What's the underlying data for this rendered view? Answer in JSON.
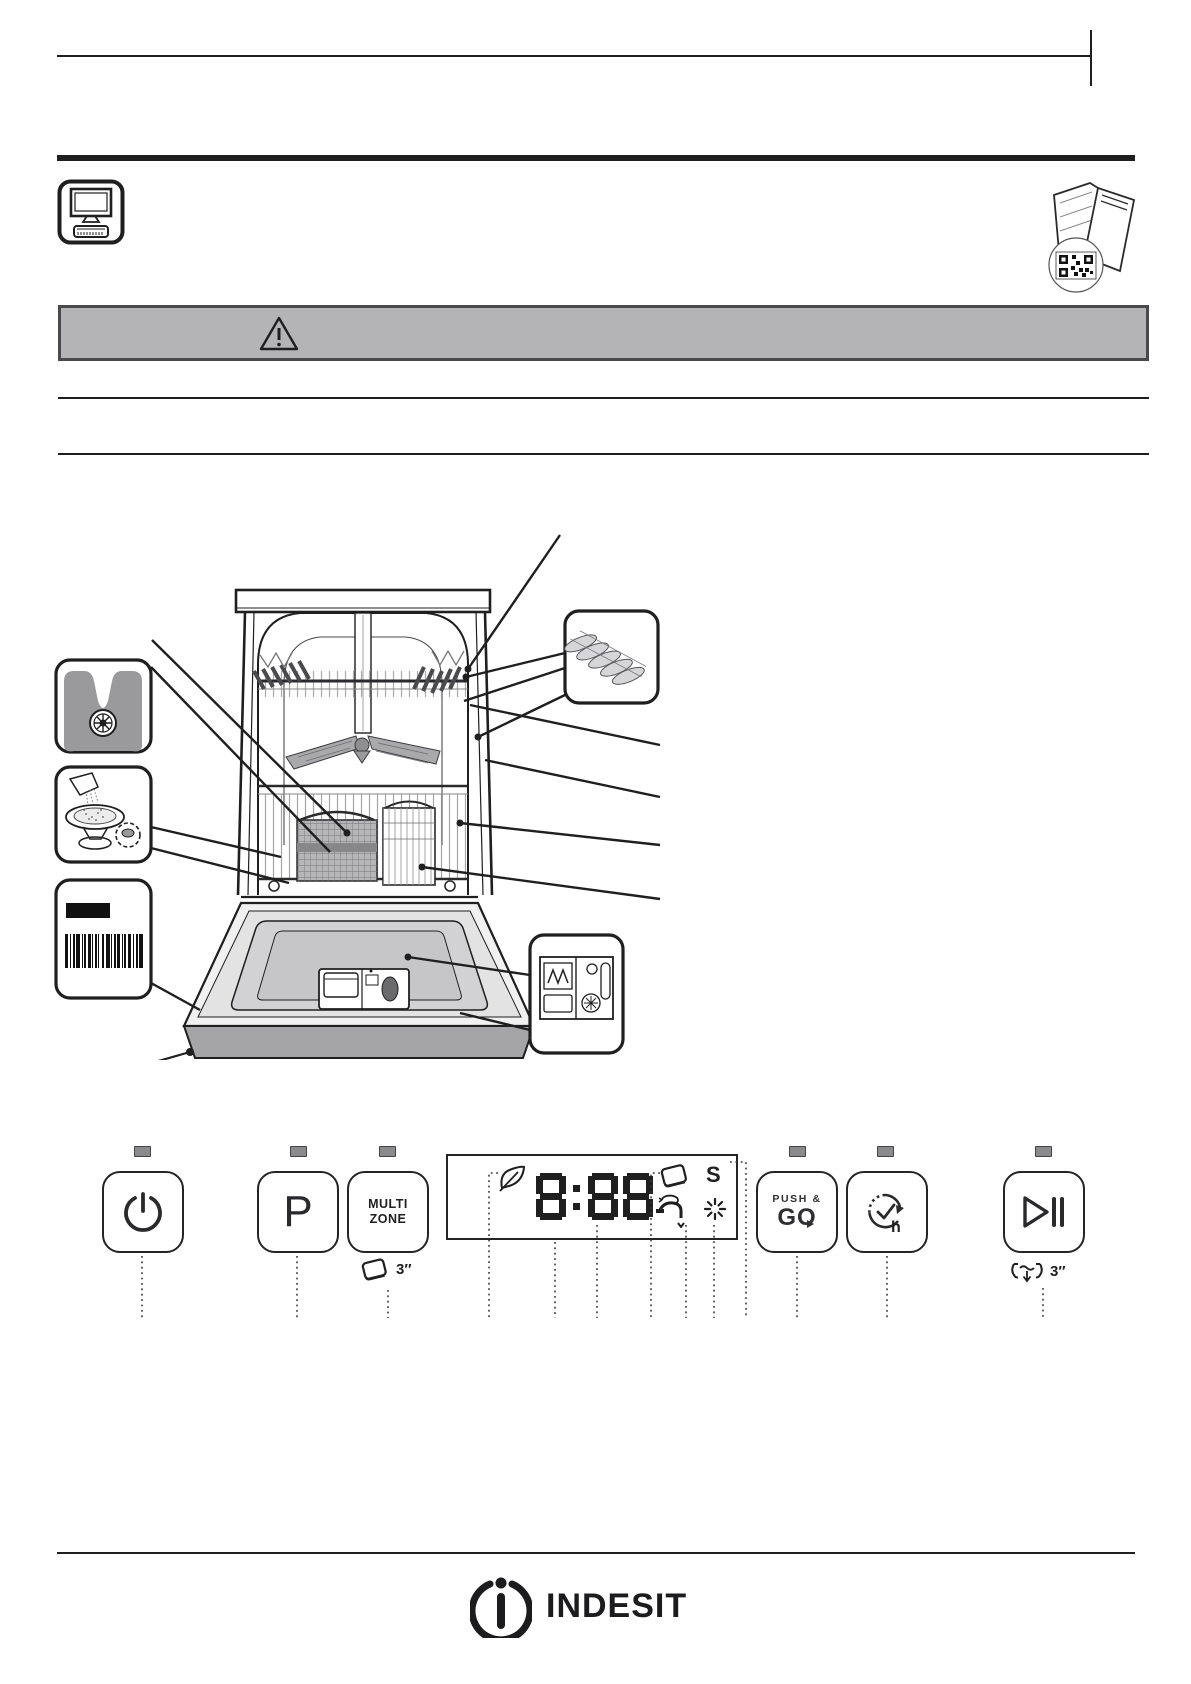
{
  "page": {
    "bg": "#ffffff",
    "ink": "#1f1f1f"
  },
  "banner": {
    "bg": "#b4b4b6",
    "border": "#4a4a4c",
    "icon": "warning-triangle"
  },
  "top_icons": {
    "left": "monitor-support",
    "right": "dishwasher-qr"
  },
  "control_panel": {
    "led_color": "#8a8a8c",
    "buttons": {
      "power": {
        "icon": "power"
      },
      "program": {
        "label": "P"
      },
      "multizone": {
        "line1": "MULTI",
        "line2": "ZONE",
        "sub_label": "3″"
      },
      "push_go": {
        "line1": "PUSH &",
        "line2": "GO"
      },
      "delay": {
        "label": "h"
      },
      "start_pause": {
        "sub_label": "3″"
      }
    },
    "display": {
      "value": "8:88",
      "salt_label": "S",
      "icons": [
        "eco-leaf",
        "detergent-tablet",
        "salt",
        "water-tap",
        "rinse-aid"
      ]
    }
  },
  "footer": {
    "brand": "INDESIT"
  }
}
